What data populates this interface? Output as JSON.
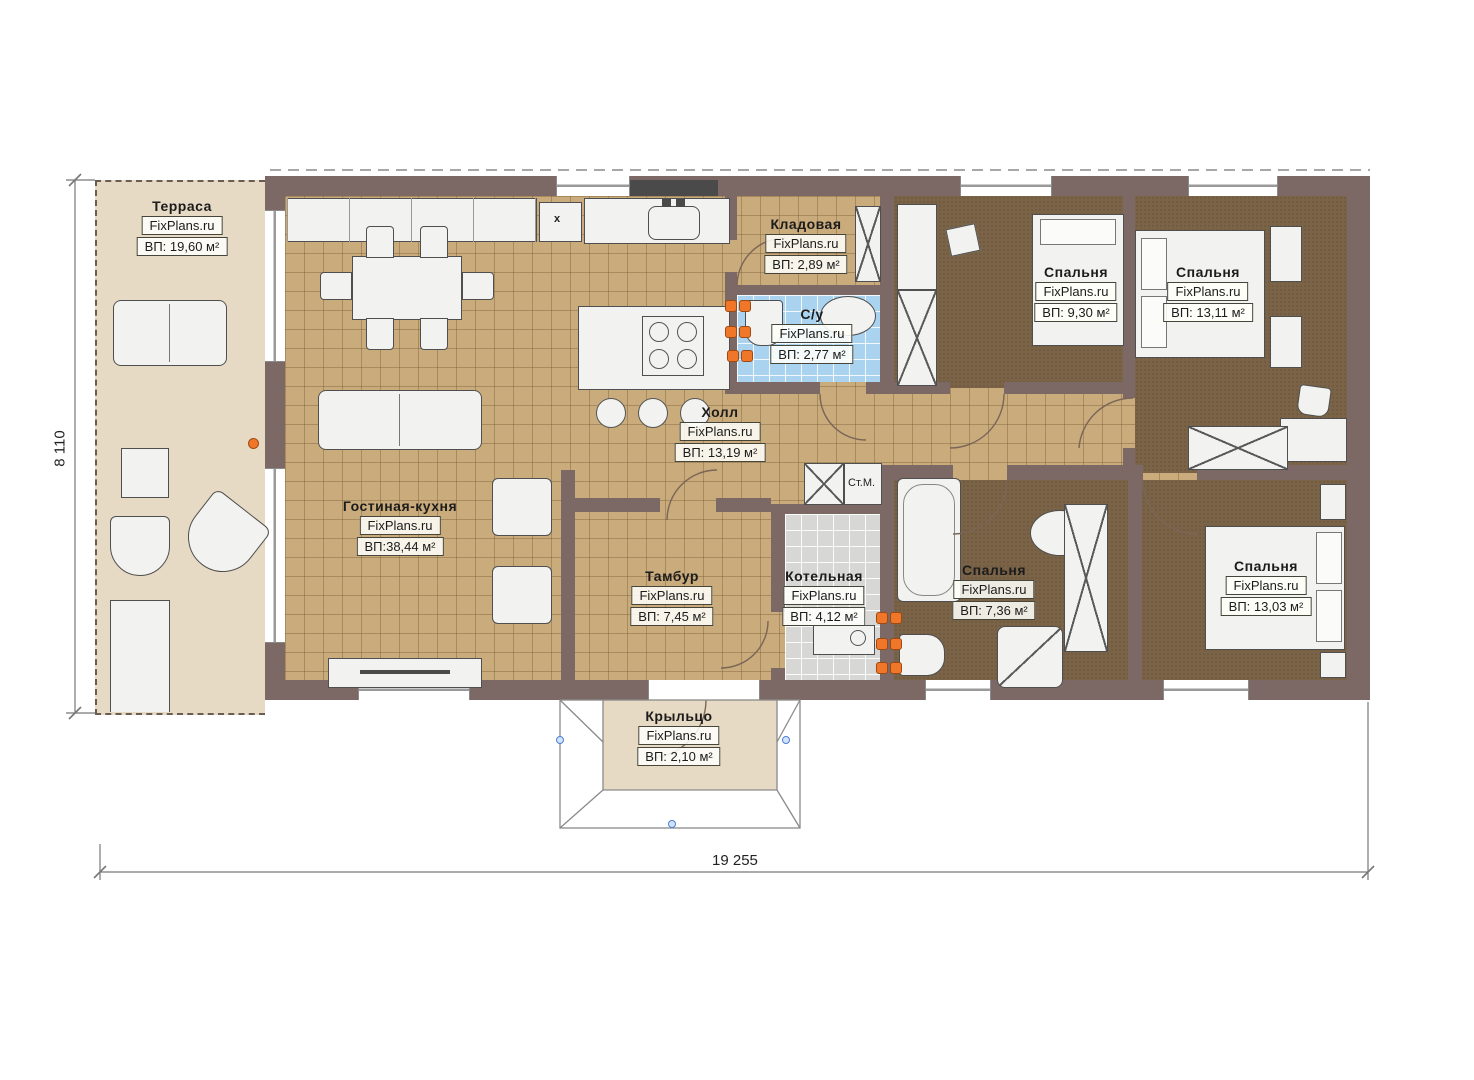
{
  "brand": "FixPlans.ru",
  "dimensions": {
    "width_label": "19 255",
    "height_label": "8 110"
  },
  "annotations": {
    "washing_machine": "Ст.М.",
    "kitchen_unit": "x"
  },
  "rooms": [
    {
      "name": "Терраса",
      "area": "ВП: 19,60 м²"
    },
    {
      "name": "Гостиная-кухня",
      "area": "ВП:38,44 м²"
    },
    {
      "name": "Кладовая",
      "area": "ВП: 2,89 м²"
    },
    {
      "name": "С/у",
      "area": "ВП: 2,77 м²"
    },
    {
      "name": "Холл",
      "area": "ВП: 13,19 м²"
    },
    {
      "name": "Спальня",
      "area": "ВП: 9,30 м²"
    },
    {
      "name": "Спальня",
      "area": "ВП: 13,11 м²"
    },
    {
      "name": "Тамбур",
      "area": "ВП: 7,45 м²"
    },
    {
      "name": "Котельная",
      "area": "ВП: 4,12 м²"
    },
    {
      "name": "Спальня",
      "area": "ВП: 7,36 м²"
    },
    {
      "name": "Спальня",
      "area": "ВП: 13,03 м²"
    },
    {
      "name": "Крыльцо",
      "area": "ВП: 2,10 м²"
    }
  ],
  "colors": {
    "wall": "#7c6864",
    "tile_floor": "#c9ab7c",
    "bedroom_floor": "#7a6347",
    "bathroom_floor": "#a9d3ef",
    "boiler_floor": "#d7d7d5",
    "terrace_floor": "#e7dac4",
    "radiator": "#f0762a"
  }
}
